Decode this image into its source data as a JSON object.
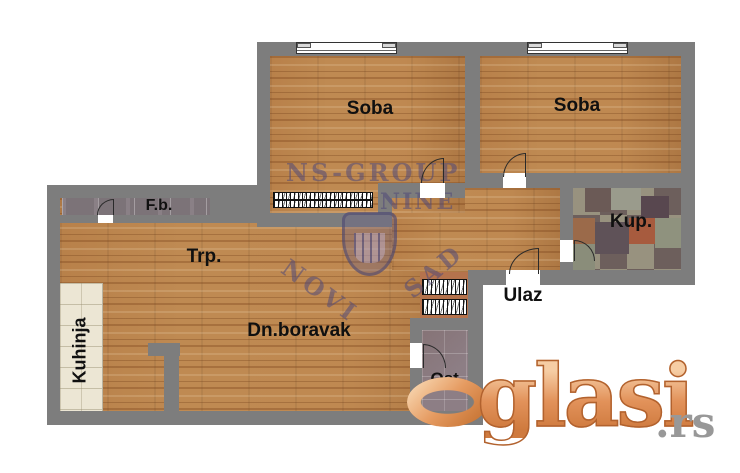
{
  "rooms": {
    "soba_left": "Soba",
    "soba_right": "Soba",
    "kupatilo": "Kup.",
    "french_balcony": "F.b.",
    "trpezarija": "Trp.",
    "dnevni_boravak": "Dn.boravak",
    "kuhinja": "Kuhinja",
    "ulaz": "Ulaz",
    "ostava": "Ost."
  },
  "branding": {
    "center_watermark": {
      "line1": "NS-GROUP",
      "line2": "NINE",
      "arc_left": "NOVI",
      "arc_right": "SAD"
    },
    "logo": {
      "rest": "glasi",
      "tld": ".rs"
    }
  },
  "colors": {
    "wall": "#7d7d7d",
    "wood_base": "#bf8a52",
    "kup_tile_base": "#8f867b",
    "ost_tile": "#8d7e85",
    "fb_tile": "#8a8086",
    "kitchen_counter": "#ece6d4",
    "closet_niche": "#b5734d",
    "logo_orange": "#e0915a",
    "logo_gray": "#989898",
    "watermark_purple": "rgba(80,72,120,0.55)"
  }
}
